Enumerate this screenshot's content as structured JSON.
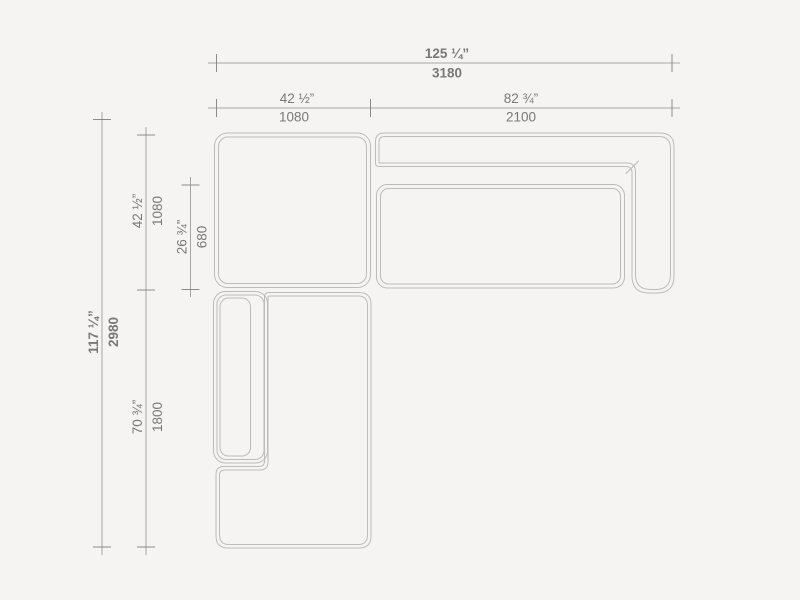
{
  "drawing": {
    "type": "sectional-sofa-plan-view",
    "units": [
      "inches",
      "mm"
    ]
  },
  "colors": {
    "background": "#f5f4f2",
    "outline": "#bcbcbc",
    "dim_line": "#a6a6a6",
    "tick": "#8c8c8c",
    "label": "#787878"
  },
  "dimensions": {
    "overall_width": {
      "inches": "125 ¼”",
      "mm": "3180"
    },
    "left_module_width": {
      "inches": "42 ½”",
      "mm": "1080"
    },
    "right_module_width": {
      "inches": "82 ¾”",
      "mm": "2100"
    },
    "overall_depth": {
      "inches": "117 ¼”",
      "mm": "2980"
    },
    "left_module_depth": {
      "inches": "42 ½”",
      "mm": "1080"
    },
    "seat_depth": {
      "inches": "26 ¾”",
      "mm": "680"
    },
    "chaise_length": {
      "inches": "70 ¾”",
      "mm": "1800"
    }
  }
}
